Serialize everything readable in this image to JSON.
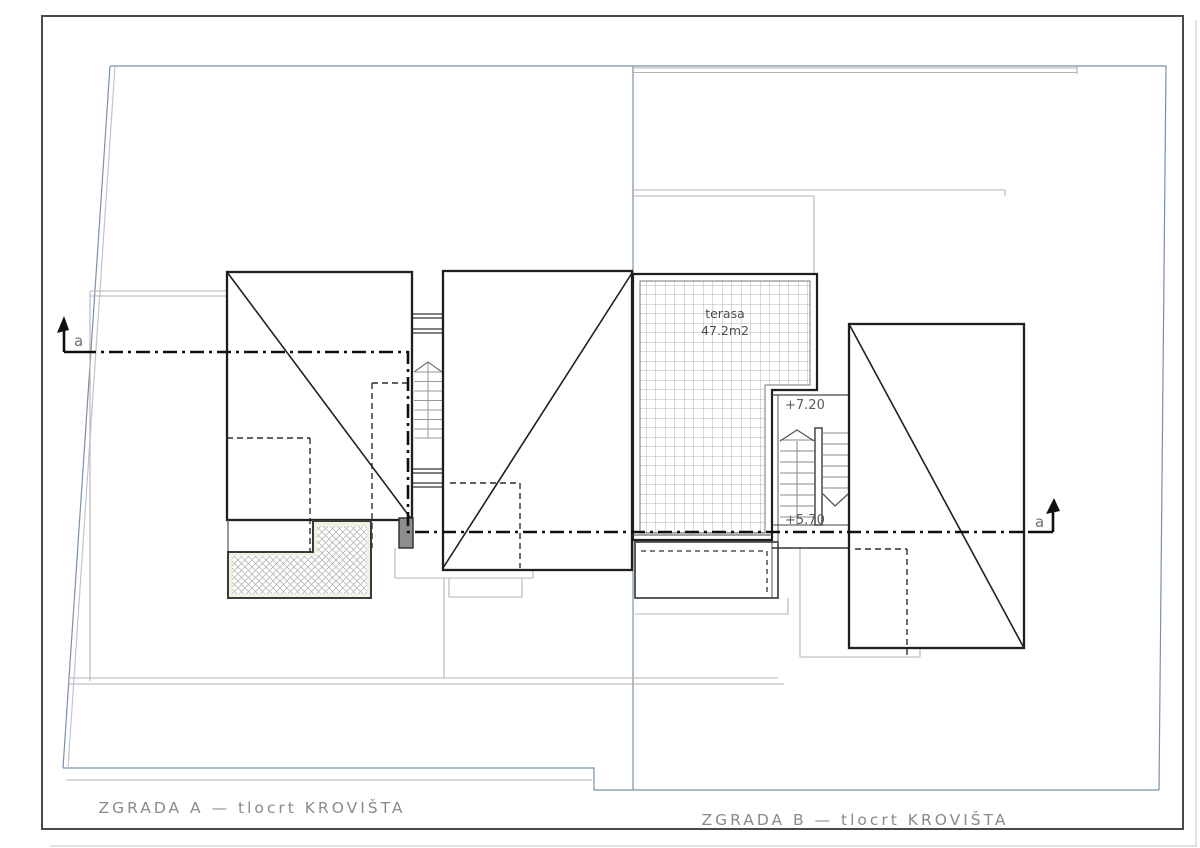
{
  "drawing": {
    "title_a": "ZGRADA A — tlocrt KROVIŠTA",
    "title_b": "ZGRADA B — tlocrt KROVIŠTA",
    "terrace": {
      "name": "terasa",
      "area": "47.2m2"
    },
    "levels": {
      "upper": "+7.20",
      "lower": "+5.70"
    },
    "section": {
      "left_label": "a",
      "right_label": "a"
    }
  },
  "colors": {
    "line_dark": "#1f1f1f",
    "line_thin": "#444444",
    "site_gray": "#b3b3b3",
    "boundary_blue": "#7792ad",
    "hatch_gray": "#9f9f9f",
    "balcony_cream": "#f2f0de",
    "chimney_fill": "#8e8e8e",
    "text_gray": "#8a8a8a"
  }
}
